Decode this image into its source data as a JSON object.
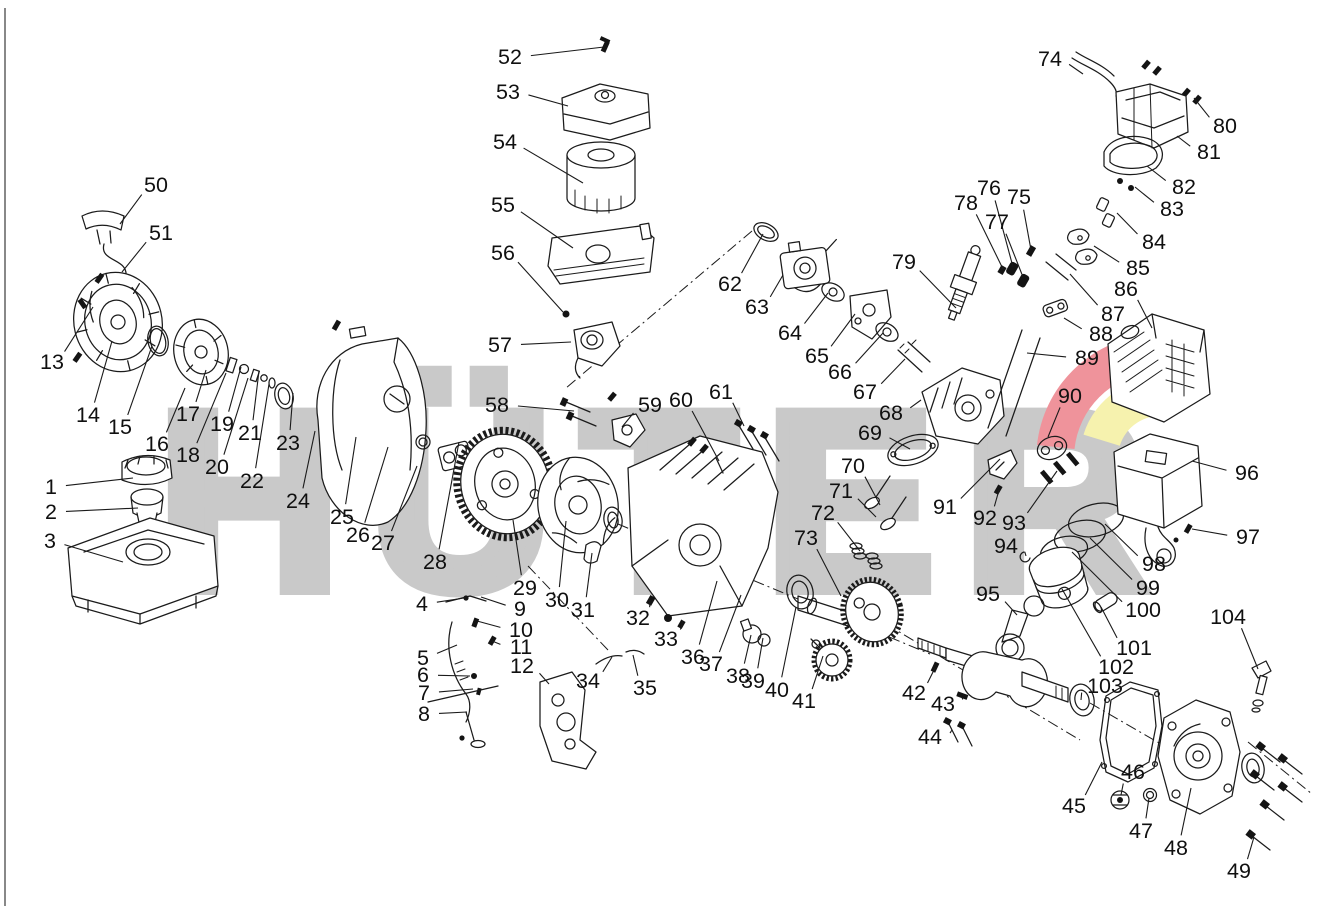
{
  "figure": {
    "type": "exploded-parts-diagram",
    "subject": "single-cylinder engine exploded view with numbered parts",
    "part_count": 104
  },
  "watermark": {
    "text": "HÜTER",
    "letter_color": "#c9c9c9",
    "swoosh_red": "#ef939b",
    "swoosh_yellow": "#f6f2ae"
  },
  "style": {
    "line_color": "#1a1a1a",
    "background": "#ffffff",
    "label_font_size": 21.5
  },
  "labels": [
    {
      "n": "1",
      "x": 51,
      "y": 487,
      "tx": 133,
      "ty": 478
    },
    {
      "n": "2",
      "x": 51,
      "y": 512,
      "tx": 138,
      "ty": 508
    },
    {
      "n": "3",
      "x": 50,
      "y": 541,
      "tx": 123,
      "ty": 562
    },
    {
      "n": "4",
      "x": 422,
      "y": 604,
      "tx": 464,
      "ty": 598
    },
    {
      "n": "5",
      "x": 423,
      "y": 658,
      "tx": 457,
      "ty": 645
    },
    {
      "n": "6",
      "x": 423,
      "y": 675,
      "tx": 470,
      "ty": 676
    },
    {
      "n": "7",
      "x": 424,
      "y": 693,
      "tx": 473,
      "ty": 689
    },
    {
      "n": "8",
      "x": 424,
      "y": 714,
      "tx": 467,
      "ty": 712
    },
    {
      "n": "9",
      "x": 520,
      "y": 609,
      "tx": 481,
      "ty": 597
    },
    {
      "n": "10",
      "x": 521,
      "y": 630,
      "tx": 477,
      "ty": 621
    },
    {
      "n": "11",
      "x": 521,
      "y": 647,
      "tx": 492,
      "ty": 641
    },
    {
      "n": "12",
      "x": 522,
      "y": 666,
      "tx": 549,
      "ty": 684
    },
    {
      "n": "13",
      "x": 52,
      "y": 362,
      "tx": 93,
      "ty": 307
    },
    {
      "n": "14",
      "x": 88,
      "y": 415,
      "tx": 112,
      "ty": 341
    },
    {
      "n": "15",
      "x": 120,
      "y": 427,
      "tx": 152,
      "ty": 346
    },
    {
      "n": "16",
      "x": 157,
      "y": 444,
      "tx": 185,
      "ty": 388
    },
    {
      "n": "17",
      "x": 188,
      "y": 414,
      "tx": 206,
      "ty": 370
    },
    {
      "n": "18",
      "x": 188,
      "y": 455,
      "tx": 226,
      "ty": 373
    },
    {
      "n": "19",
      "x": 222,
      "y": 424,
      "tx": 241,
      "ty": 367
    },
    {
      "n": "20",
      "x": 217,
      "y": 467,
      "tx": 248,
      "ty": 378
    },
    {
      "n": "21",
      "x": 250,
      "y": 433,
      "tx": 259,
      "ty": 371
    },
    {
      "n": "22",
      "x": 252,
      "y": 481,
      "tx": 269,
      "ty": 384
    },
    {
      "n": "23",
      "x": 288,
      "y": 443,
      "tx": 293,
      "ty": 393
    },
    {
      "n": "24",
      "x": 298,
      "y": 501,
      "tx": 315,
      "ty": 431
    },
    {
      "n": "25",
      "x": 342,
      "y": 517,
      "tx": 356,
      "ty": 437
    },
    {
      "n": "26",
      "x": 358,
      "y": 535,
      "tx": 388,
      "ty": 447
    },
    {
      "n": "27",
      "x": 383,
      "y": 543,
      "tx": 417,
      "ty": 466
    },
    {
      "n": "28",
      "x": 435,
      "y": 562,
      "tx": 459,
      "ty": 442
    },
    {
      "n": "29",
      "x": 525,
      "y": 588,
      "tx": 513,
      "ty": 520
    },
    {
      "n": "30",
      "x": 557,
      "y": 600,
      "tx": 566,
      "ty": 521
    },
    {
      "n": "31",
      "x": 583,
      "y": 610,
      "tx": 592,
      "ty": 553
    },
    {
      "n": "32",
      "x": 638,
      "y": 618,
      "tx": 650,
      "ty": 600
    },
    {
      "n": "33",
      "x": 666,
      "y": 639,
      "tx": 683,
      "ty": 621
    },
    {
      "n": "34",
      "x": 588,
      "y": 681,
      "tx": 612,
      "ty": 657
    },
    {
      "n": "35",
      "x": 645,
      "y": 688,
      "tx": 633,
      "ty": 655
    },
    {
      "n": "36",
      "x": 693,
      "y": 657,
      "tx": 717,
      "ty": 581
    },
    {
      "n": "37",
      "x": 711,
      "y": 664,
      "tx": 741,
      "ty": 595
    },
    {
      "n": "38",
      "x": 738,
      "y": 676,
      "tx": 751,
      "ty": 635
    },
    {
      "n": "39",
      "x": 753,
      "y": 681,
      "tx": 763,
      "ty": 638
    },
    {
      "n": "40",
      "x": 777,
      "y": 690,
      "tx": 796,
      "ty": 607
    },
    {
      "n": "41",
      "x": 804,
      "y": 701,
      "tx": 823,
      "ty": 656
    },
    {
      "n": "42",
      "x": 914,
      "y": 693,
      "tx": 935,
      "ty": 668
    },
    {
      "n": "43",
      "x": 943,
      "y": 704,
      "tx": 962,
      "ty": 697
    },
    {
      "n": "44",
      "x": 930,
      "y": 737,
      "tx": 952,
      "ty": 730
    },
    {
      "n": "45",
      "x": 1074,
      "y": 806,
      "tx": 1102,
      "ty": 762
    },
    {
      "n": "46",
      "x": 1133,
      "y": 772,
      "tx": 1121,
      "ty": 795
    },
    {
      "n": "47",
      "x": 1141,
      "y": 831,
      "tx": 1149,
      "ty": 798
    },
    {
      "n": "48",
      "x": 1176,
      "y": 848,
      "tx": 1191,
      "ty": 788
    },
    {
      "n": "49",
      "x": 1239,
      "y": 871,
      "tx": 1254,
      "ty": 837
    },
    {
      "n": "50",
      "x": 156,
      "y": 185,
      "tx": 120,
      "ty": 224
    },
    {
      "n": "51",
      "x": 161,
      "y": 233,
      "tx": 122,
      "ty": 272
    },
    {
      "n": "52",
      "x": 510,
      "y": 57,
      "tx": 604,
      "ty": 47
    },
    {
      "n": "53",
      "x": 508,
      "y": 92,
      "tx": 568,
      "ty": 106
    },
    {
      "n": "54",
      "x": 505,
      "y": 142,
      "tx": 583,
      "ty": 183
    },
    {
      "n": "55",
      "x": 503,
      "y": 205,
      "tx": 573,
      "ty": 248
    },
    {
      "n": "56",
      "x": 503,
      "y": 253,
      "tx": 563,
      "ty": 312
    },
    {
      "n": "57",
      "x": 500,
      "y": 345,
      "tx": 571,
      "ty": 342
    },
    {
      "n": "58",
      "x": 497,
      "y": 405,
      "tx": 574,
      "ty": 411
    },
    {
      "n": "59",
      "x": 650,
      "y": 405,
      "tx": 622,
      "ty": 427
    },
    {
      "n": "60",
      "x": 681,
      "y": 400,
      "tx": 719,
      "ty": 461
    },
    {
      "n": "61",
      "x": 721,
      "y": 392,
      "tx": 744,
      "ty": 426
    },
    {
      "n": "62",
      "x": 730,
      "y": 284,
      "tx": 763,
      "ty": 234
    },
    {
      "n": "63",
      "x": 757,
      "y": 307,
      "tx": 783,
      "ty": 275
    },
    {
      "n": "64",
      "x": 790,
      "y": 333,
      "tx": 828,
      "ty": 293
    },
    {
      "n": "65",
      "x": 817,
      "y": 356,
      "tx": 855,
      "ty": 314
    },
    {
      "n": "66",
      "x": 840,
      "y": 372,
      "tx": 883,
      "ty": 333
    },
    {
      "n": "67",
      "x": 865,
      "y": 392,
      "tx": 905,
      "ty": 359
    },
    {
      "n": "68",
      "x": 891,
      "y": 413,
      "tx": 921,
      "ty": 400
    },
    {
      "n": "69",
      "x": 870,
      "y": 433,
      "tx": 910,
      "ty": 449
    },
    {
      "n": "70",
      "x": 853,
      "y": 466,
      "tx": 880,
      "ty": 505
    },
    {
      "n": "71",
      "x": 841,
      "y": 491,
      "tx": 876,
      "ty": 517
    },
    {
      "n": "72",
      "x": 823,
      "y": 513,
      "tx": 860,
      "ty": 551
    },
    {
      "n": "73",
      "x": 806,
      "y": 538,
      "tx": 841,
      "ty": 596
    },
    {
      "n": "74",
      "x": 1050,
      "y": 59,
      "tx": 1083,
      "ty": 74
    },
    {
      "n": "75",
      "x": 1019,
      "y": 197,
      "tx": 1031,
      "ty": 250
    },
    {
      "n": "76",
      "x": 989,
      "y": 188,
      "tx": 1013,
      "ty": 267
    },
    {
      "n": "77",
      "x": 997,
      "y": 222,
      "tx": 1023,
      "ty": 277
    },
    {
      "n": "78",
      "x": 966,
      "y": 203,
      "tx": 1003,
      "ty": 269
    },
    {
      "n": "79",
      "x": 904,
      "y": 262,
      "tx": 956,
      "ty": 308
    },
    {
      "n": "80",
      "x": 1225,
      "y": 126,
      "tx": 1194,
      "ty": 98
    },
    {
      "n": "81",
      "x": 1209,
      "y": 152,
      "tx": 1177,
      "ty": 136
    },
    {
      "n": "82",
      "x": 1184,
      "y": 187,
      "tx": 1147,
      "ty": 166
    },
    {
      "n": "83",
      "x": 1172,
      "y": 209,
      "tx": 1135,
      "ty": 187
    },
    {
      "n": "84",
      "x": 1154,
      "y": 242,
      "tx": 1117,
      "ty": 213
    },
    {
      "n": "85",
      "x": 1138,
      "y": 268,
      "tx": 1094,
      "ty": 246
    },
    {
      "n": "86",
      "x": 1126,
      "y": 289,
      "tx": 1152,
      "ty": 328
    },
    {
      "n": "87",
      "x": 1113,
      "y": 314,
      "tx": 1070,
      "ty": 274
    },
    {
      "n": "88",
      "x": 1101,
      "y": 334,
      "tx": 1064,
      "ty": 318
    },
    {
      "n": "89",
      "x": 1087,
      "y": 358,
      "tx": 1027,
      "ty": 353
    },
    {
      "n": "90",
      "x": 1070,
      "y": 396,
      "tx": 1048,
      "ty": 437
    },
    {
      "n": "91",
      "x": 945,
      "y": 507,
      "tx": 1000,
      "ty": 459
    },
    {
      "n": "92",
      "x": 985,
      "y": 518,
      "tx": 999,
      "ty": 490
    },
    {
      "n": "93",
      "x": 1014,
      "y": 523,
      "tx": 1057,
      "ty": 471
    },
    {
      "n": "94",
      "x": 1006,
      "y": 546,
      "tx": 1026,
      "ty": 556
    },
    {
      "n": "95",
      "x": 988,
      "y": 594,
      "tx": 1017,
      "ty": 615
    },
    {
      "n": "96",
      "x": 1247,
      "y": 473,
      "tx": 1192,
      "ty": 461
    },
    {
      "n": "97",
      "x": 1248,
      "y": 537,
      "tx": 1192,
      "ty": 529
    },
    {
      "n": "98",
      "x": 1154,
      "y": 564,
      "tx": 1105,
      "ty": 524
    },
    {
      "n": "99",
      "x": 1148,
      "y": 588,
      "tx": 1090,
      "ty": 538
    },
    {
      "n": "100",
      "x": 1143,
      "y": 610,
      "tx": 1072,
      "ty": 552
    },
    {
      "n": "101",
      "x": 1134,
      "y": 648,
      "tx": 1101,
      "ty": 607
    },
    {
      "n": "102",
      "x": 1116,
      "y": 667,
      "tx": 1062,
      "ty": 589
    },
    {
      "n": "103",
      "x": 1105,
      "y": 686,
      "tx": 1081,
      "ty": 700
    },
    {
      "n": "104",
      "x": 1228,
      "y": 617,
      "tx": 1258,
      "ty": 669
    }
  ]
}
